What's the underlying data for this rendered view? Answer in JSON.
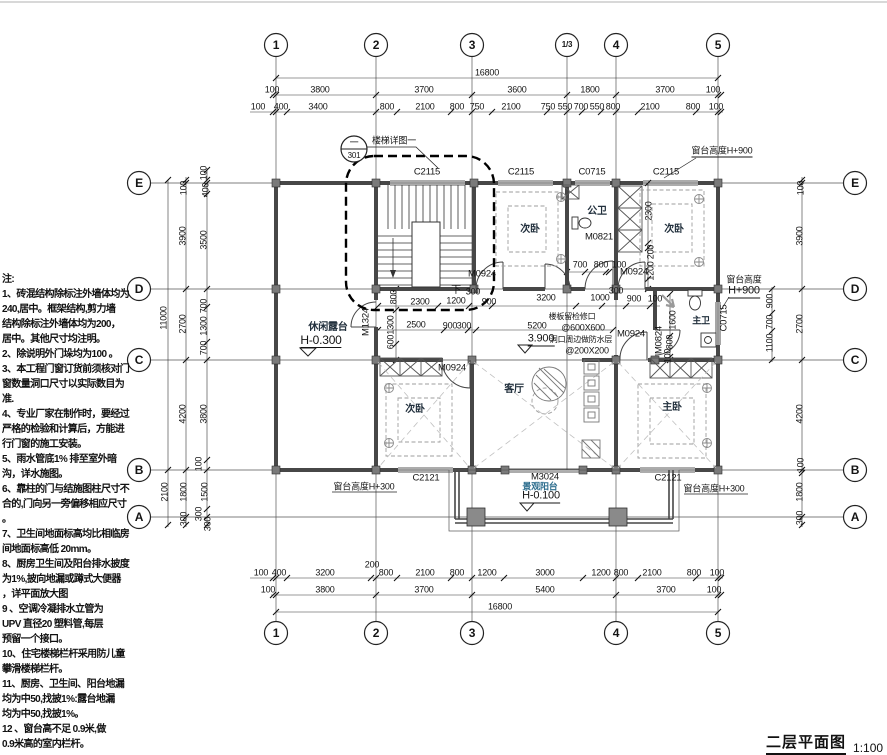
{
  "meta": {
    "title": "二层平面图",
    "scale": "1:100"
  },
  "callout": {
    "num": "一",
    "sheet": "301",
    "label": "楼梯详图一"
  },
  "axis_bubbles": [
    {
      "t": "1",
      "x": 276,
      "y": 45
    },
    {
      "t": "2",
      "x": 376,
      "y": 45
    },
    {
      "t": "3",
      "x": 472,
      "y": 45
    },
    {
      "t": "1/3",
      "x": 567,
      "y": 45,
      "s": 8
    },
    {
      "t": "4",
      "x": 616,
      "y": 45
    },
    {
      "t": "5",
      "x": 718,
      "y": 45
    },
    {
      "t": "1",
      "x": 276,
      "y": 633
    },
    {
      "t": "2",
      "x": 376,
      "y": 633
    },
    {
      "t": "3",
      "x": 472,
      "y": 633
    },
    {
      "t": "4",
      "x": 616,
      "y": 633
    },
    {
      "t": "5",
      "x": 718,
      "y": 633
    },
    {
      "t": "E",
      "x": 139,
      "y": 183
    },
    {
      "t": "D",
      "x": 139,
      "y": 289
    },
    {
      "t": "C",
      "x": 139,
      "y": 360
    },
    {
      "t": "B",
      "x": 139,
      "y": 470
    },
    {
      "t": "A",
      "x": 139,
      "y": 517
    },
    {
      "t": "E",
      "x": 855,
      "y": 183
    },
    {
      "t": "D",
      "x": 855,
      "y": 289
    },
    {
      "t": "C",
      "x": 855,
      "y": 360
    },
    {
      "t": "B",
      "x": 855,
      "y": 470
    },
    {
      "t": "A",
      "x": 855,
      "y": 517
    }
  ],
  "dims": [
    {
      "t": "16800",
      "x": 487,
      "y": 73
    },
    {
      "t": "100",
      "x": 272,
      "y": 90
    },
    {
      "t": "3800",
      "x": 320,
      "y": 90
    },
    {
      "t": "3700",
      "x": 424,
      "y": 90
    },
    {
      "t": "3600",
      "x": 517,
      "y": 90
    },
    {
      "t": "1800",
      "x": 590,
      "y": 90
    },
    {
      "t": "3700",
      "x": 665,
      "y": 90
    },
    {
      "t": "100",
      "x": 713,
      "y": 90
    },
    {
      "t": "100",
      "x": 258,
      "y": 107
    },
    {
      "t": "400",
      "x": 281,
      "y": 107
    },
    {
      "t": "3400",
      "x": 318,
      "y": 107
    },
    {
      "t": "800",
      "x": 387,
      "y": 107
    },
    {
      "t": "2100",
      "x": 425,
      "y": 107
    },
    {
      "t": "800",
      "x": 457,
      "y": 107
    },
    {
      "t": "750",
      "x": 477,
      "y": 107
    },
    {
      "t": "2100",
      "x": 511,
      "y": 107
    },
    {
      "t": "750",
      "x": 548,
      "y": 107
    },
    {
      "t": "550",
      "x": 565,
      "y": 107
    },
    {
      "t": "700",
      "x": 581,
      "y": 107
    },
    {
      "t": "550",
      "x": 597,
      "y": 107
    },
    {
      "t": "800",
      "x": 613,
      "y": 107
    },
    {
      "t": "2100",
      "x": 650,
      "y": 107
    },
    {
      "t": "800",
      "x": 693,
      "y": 107
    },
    {
      "t": "100",
      "x": 716,
      "y": 107
    },
    {
      "t": "100",
      "x": 261,
      "y": 573
    },
    {
      "t": "400",
      "x": 279,
      "y": 573
    },
    {
      "t": "3200",
      "x": 325,
      "y": 573
    },
    {
      "t": "200",
      "x": 372,
      "y": 565
    },
    {
      "t": "800",
      "x": 386,
      "y": 573
    },
    {
      "t": "2100",
      "x": 425,
      "y": 573
    },
    {
      "t": "800",
      "x": 457,
      "y": 573
    },
    {
      "t": "1200",
      "x": 487,
      "y": 573
    },
    {
      "t": "3000",
      "x": 545,
      "y": 573
    },
    {
      "t": "1200",
      "x": 601,
      "y": 573
    },
    {
      "t": "800",
      "x": 621,
      "y": 573
    },
    {
      "t": "2100",
      "x": 652,
      "y": 573
    },
    {
      "t": "800",
      "x": 694,
      "y": 573
    },
    {
      "t": "100",
      "x": 717,
      "y": 573
    },
    {
      "t": "100",
      "x": 268,
      "y": 590
    },
    {
      "t": "3800",
      "x": 325,
      "y": 590
    },
    {
      "t": "3700",
      "x": 424,
      "y": 590
    },
    {
      "t": "5400",
      "x": 545,
      "y": 590
    },
    {
      "t": "3700",
      "x": 666,
      "y": 590
    },
    {
      "t": "100",
      "x": 714,
      "y": 590
    },
    {
      "t": "16800",
      "x": 500,
      "y": 607
    },
    {
      "t": "11000",
      "x": 164,
      "y": 318,
      "r": -90
    },
    {
      "t": "2100",
      "x": 165,
      "y": 492,
      "r": -90
    },
    {
      "t": "100",
      "x": 184,
      "y": 188,
      "r": -90
    },
    {
      "t": "3900",
      "x": 183,
      "y": 236,
      "r": -90
    },
    {
      "t": "2700",
      "x": 183,
      "y": 324,
      "r": -90
    },
    {
      "t": "4200",
      "x": 183,
      "y": 414,
      "r": -90
    },
    {
      "t": "1800",
      "x": 184,
      "y": 492,
      "r": -90
    },
    {
      "t": "300",
      "x": 184,
      "y": 519,
      "r": -90
    },
    {
      "t": "100",
      "x": 204,
      "y": 173,
      "r": -90
    },
    {
      "t": "400",
      "x": 206,
      "y": 190,
      "r": -90
    },
    {
      "t": "3500",
      "x": 204,
      "y": 240,
      "r": -90
    },
    {
      "t": "700",
      "x": 204,
      "y": 306,
      "r": -90
    },
    {
      "t": "1300",
      "x": 204,
      "y": 326,
      "r": -90
    },
    {
      "t": "700",
      "x": 204,
      "y": 348,
      "r": -90
    },
    {
      "t": "3800",
      "x": 204,
      "y": 414,
      "r": -90
    },
    {
      "t": "100",
      "x": 199,
      "y": 464,
      "r": -90
    },
    {
      "t": "1500",
      "x": 205,
      "y": 492,
      "r": -90
    },
    {
      "t": "300",
      "x": 199,
      "y": 514,
      "r": -90
    },
    {
      "t": "300",
      "x": 208,
      "y": 524,
      "r": -90
    },
    {
      "t": "100",
      "x": 801,
      "y": 188,
      "r": -90
    },
    {
      "t": "3900",
      "x": 800,
      "y": 236,
      "r": -90
    },
    {
      "t": "2700",
      "x": 800,
      "y": 324,
      "r": -90
    },
    {
      "t": "4200",
      "x": 800,
      "y": 414,
      "r": -90
    },
    {
      "t": "100",
      "x": 801,
      "y": 465,
      "r": -90
    },
    {
      "t": "1800",
      "x": 800,
      "y": 492,
      "r": -90
    },
    {
      "t": "300",
      "x": 800,
      "y": 518,
      "r": -90
    },
    {
      "t": "900",
      "x": 770,
      "y": 301,
      "r": -90
    },
    {
      "t": "700",
      "x": 770,
      "y": 322,
      "r": -90
    },
    {
      "t": "1100",
      "x": 770,
      "y": 343,
      "r": -90
    },
    {
      "t": "800",
      "x": 394,
      "y": 297,
      "r": -90
    },
    {
      "t": "1300",
      "x": 391,
      "y": 325,
      "r": -90
    },
    {
      "t": "600",
      "x": 391,
      "y": 342,
      "r": -90
    },
    {
      "t": "2300",
      "x": 420,
      "y": 302
    },
    {
      "t": "1200",
      "x": 456,
      "y": 301
    },
    {
      "t": "900",
      "x": 489,
      "y": 302
    },
    {
      "t": "3200",
      "x": 546,
      "y": 298
    },
    {
      "t": "1000",
      "x": 600,
      "y": 298
    },
    {
      "t": "900",
      "x": 634,
      "y": 299
    },
    {
      "t": "100",
      "x": 655,
      "y": 299
    },
    {
      "t": "300",
      "x": 473,
      "y": 292
    },
    {
      "t": "300",
      "x": 616,
      "y": 291
    },
    {
      "t": "2500",
      "x": 416,
      "y": 325
    },
    {
      "t": "900",
      "x": 450,
      "y": 326
    },
    {
      "t": "300",
      "x": 464,
      "y": 326
    },
    {
      "t": "5200",
      "x": 537,
      "y": 326
    },
    {
      "t": "700",
      "x": 580,
      "y": 265
    },
    {
      "t": "800",
      "x": 601,
      "y": 265
    },
    {
      "t": "100",
      "x": 619,
      "y": 265
    },
    {
      "t": "2300",
      "x": 649,
      "y": 211,
      "r": -90
    },
    {
      "t": "200",
      "x": 651,
      "y": 252,
      "r": -90
    },
    {
      "t": "1200",
      "x": 651,
      "y": 271,
      "r": -90
    },
    {
      "t": "1600",
      "x": 673,
      "y": 320,
      "r": -90
    },
    {
      "t": "800",
      "x": 670,
      "y": 342,
      "r": -90
    },
    {
      "t": "100",
      "x": 668,
      "y": 356,
      "r": -90
    }
  ],
  "openings": [
    {
      "t": "C2115",
      "x": 427,
      "y": 172
    },
    {
      "t": "C2115",
      "x": 521,
      "y": 172
    },
    {
      "t": "C0715",
      "x": 592,
      "y": 172
    },
    {
      "t": "C2115",
      "x": 666,
      "y": 172
    },
    {
      "t": "C2121",
      "x": 426,
      "y": 478
    },
    {
      "t": "C2121",
      "x": 668,
      "y": 478
    },
    {
      "t": "M3024",
      "x": 545,
      "y": 477
    },
    {
      "t": "C0715",
      "x": 724,
      "y": 318,
      "r": -90
    },
    {
      "t": "M0924",
      "x": 482,
      "y": 274
    },
    {
      "t": "M0924",
      "x": 634,
      "y": 272
    },
    {
      "t": "M0924",
      "x": 631,
      "y": 334
    },
    {
      "t": "M0924",
      "x": 452,
      "y": 368
    },
    {
      "t": "M0821",
      "x": 599,
      "y": 237
    },
    {
      "t": "M0824",
      "x": 659,
      "y": 340,
      "r": -90
    },
    {
      "t": "M1324",
      "x": 366,
      "y": 322,
      "r": -90
    }
  ],
  "rooms": [
    {
      "t": "次卧",
      "x": 530,
      "y": 230
    },
    {
      "t": "公卫",
      "x": 597,
      "y": 212
    },
    {
      "t": "次卧",
      "x": 674,
      "y": 230
    },
    {
      "t": "休闲露台",
      "x": 328,
      "y": 328
    },
    {
      "t": "客厅",
      "x": 514,
      "y": 390
    },
    {
      "t": "次卧",
      "x": 415,
      "y": 410
    },
    {
      "t": "主卧",
      "x": 672,
      "y": 408
    },
    {
      "t": "主卫",
      "x": 701,
      "y": 321,
      "s": 9
    },
    {
      "t": "景观阳台",
      "x": 540,
      "y": 487,
      "s": 9,
      "c": "teal"
    }
  ],
  "annotations": [
    {
      "t": "下",
      "x": 456,
      "y": 291,
      "s": 10
    },
    {
      "t": "楼梯详图一",
      "x": 394,
      "y": 141,
      "s": 9
    },
    {
      "t": "一",
      "x": 354,
      "y": 143,
      "s": 9
    },
    {
      "t": "301",
      "x": 354,
      "y": 156,
      "s": 8
    },
    {
      "t": "窗台高度H+900",
      "x": 722,
      "y": 152,
      "s": 9,
      "c": "u"
    },
    {
      "t": "窗台高度",
      "x": 744,
      "y": 280,
      "s": 9
    },
    {
      "t": "H+900",
      "x": 744,
      "y": 292,
      "s": 11,
      "c": "u"
    },
    {
      "t": "窗台高度H+300",
      "x": 364,
      "y": 487,
      "s": 9
    },
    {
      "t": "窗台高度H+300",
      "x": 714,
      "y": 489,
      "s": 9
    },
    {
      "t": "H-0.300",
      "x": 321,
      "y": 341,
      "s": 12,
      "c": "u"
    },
    {
      "t": "3.900",
      "x": 541,
      "y": 340,
      "s": 11,
      "c": "u"
    },
    {
      "t": "H-0.100",
      "x": 541,
      "y": 497,
      "s": 11,
      "c": "u"
    },
    {
      "t": "楼板留检修口",
      "x": 572,
      "y": 317,
      "s": 8
    },
    {
      "t": "@600X600",
      "x": 583,
      "y": 328,
      "s": 9
    },
    {
      "t": "洞口周边做防水层",
      "x": 581,
      "y": 340,
      "s": 8
    },
    {
      "t": "@200X200",
      "x": 587,
      "y": 351,
      "s": 9
    }
  ],
  "notes": {
    "lines": [
      {
        "t": "注:"
      },
      {
        "t": "1、砖混结构除标注外墙体均为"
      },
      {
        "t": "240,居中。框架结构,剪力墙"
      },
      {
        "t": "结构除标注外墙体均为200，"
      },
      {
        "t": "居中。其他尺寸均注明。"
      },
      {
        "t": "2、除说明外门垛均为100 。"
      },
      {
        "t": "3、本工程门窗订货前须核对门"
      },
      {
        "t": "窗数量洞口尺寸以实际数目为"
      },
      {
        "t": "准."
      },
      {
        "t": "4、专业厂家在制作时，要经过"
      },
      {
        "t": "严格的检验和计算后，方能进"
      },
      {
        "t": "行门窗的施工安装。"
      },
      {
        "t": "5、雨水管底1% 排至室外暗"
      },
      {
        "t": "沟，详水施图。"
      },
      {
        "t": "6、靠柱的门与结施图柱尺寸不"
      },
      {
        "t": "合的,门向另一旁偏移相应尺寸"
      },
      {
        "t": "。"
      },
      {
        "t": "7、卫生间地面标高均比相临房"
      },
      {
        "t": "间地面标高低 20mm。"
      },
      {
        "t": "8、厨房卫生间及阳台排水披度"
      },
      {
        "t": "为1%,披向地漏或蹲式大便器"
      },
      {
        "t": "，详平面放大图"
      },
      {
        "t": "9 、空调冷凝排水立管为"
      },
      {
        "t": "UPV 直径20 塑料管,每层"
      },
      {
        "t": "预留一个接口。"
      },
      {
        "t": "10、住宅楼梯栏杆采用防儿童"
      },
      {
        "t": "攀滑楼梯栏杆。"
      },
      {
        "t": "11、厨房、卫生间、阳台地漏"
      },
      {
        "t": "均为中50,找披1%:露台地漏"
      },
      {
        "t": "均为中50,找披1%。"
      },
      {
        "t": "12 、窗台高不足 0.9米,做"
      },
      {
        "t": "0.9米高的室内栏杆。"
      }
    ]
  }
}
